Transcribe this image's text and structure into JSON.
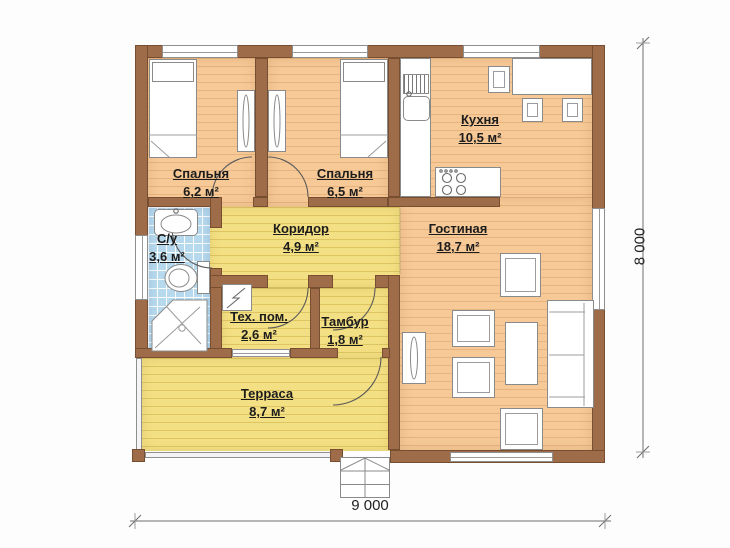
{
  "plan": {
    "type": "floor-plan",
    "rooms": [
      {
        "name": "Спальня",
        "area": "6,2 м²"
      },
      {
        "name": "Спальня",
        "area": "6,5 м²"
      },
      {
        "name": "Кухня",
        "area": "10,5 м²"
      },
      {
        "name": "С/у",
        "area": "3,6 м²"
      },
      {
        "name": "Коридор",
        "area": "4,9 м²"
      },
      {
        "name": "Гостиная",
        "area": "18,7 м²"
      },
      {
        "name": "Тех. пом.",
        "area": "2,6 м²"
      },
      {
        "name": "Тамбур",
        "area": "1,8 м²"
      },
      {
        "name": "Терраса",
        "area": "8,7 м²"
      }
    ],
    "dimensions": {
      "width_label": "9 000",
      "height_label": "8 000"
    },
    "symbols": [
      "bed",
      "pillow",
      "wardrobe",
      "washbasin",
      "toilet",
      "shower-tray",
      "boiler",
      "kitchen-counter",
      "kitchen-sink",
      "stove",
      "dining-table",
      "chair",
      "tv",
      "armchair",
      "coffee-table",
      "sofa",
      "entrance-steps",
      "door-swing",
      "window",
      "railing"
    ],
    "colors": {
      "wall": "#9e6c49",
      "wood_floor": "#f6c997",
      "yellow_floor": "#f4e084",
      "tile_floor": "#b7d9ed",
      "text": "#1c1c1c",
      "drawing_line": "#5a5a5a"
    }
  }
}
